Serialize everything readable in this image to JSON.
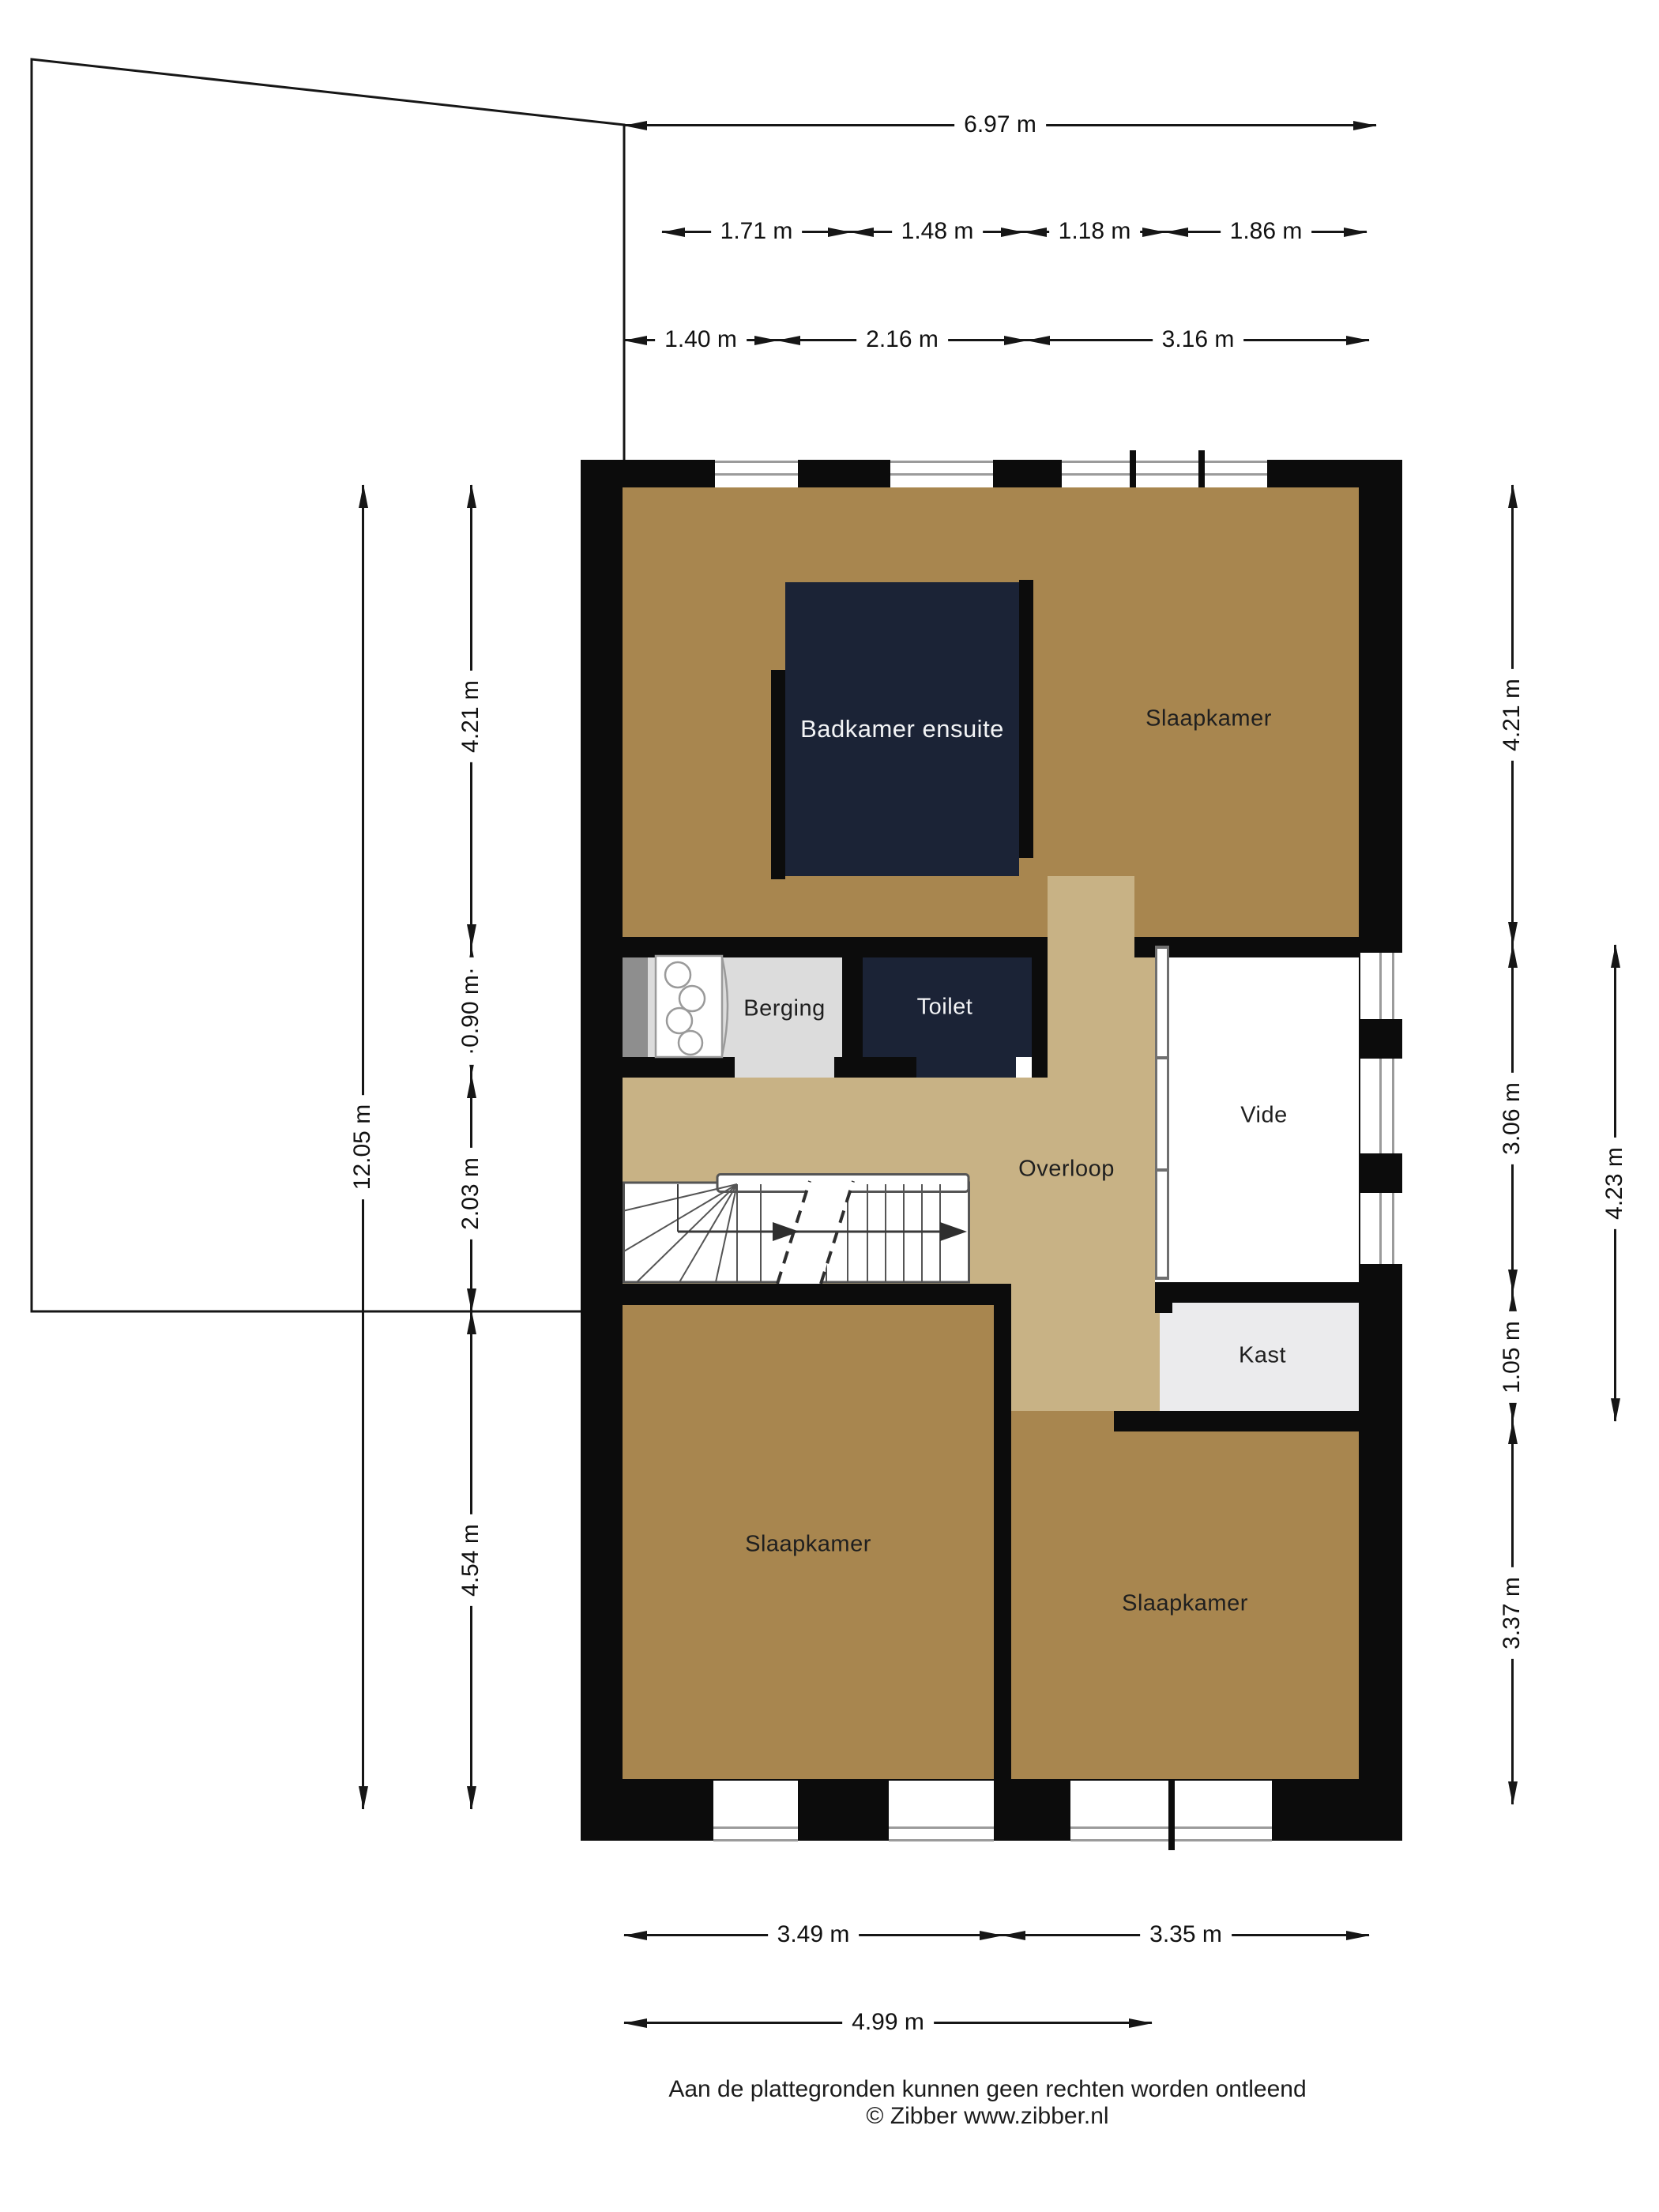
{
  "floorplan": {
    "rooms": {
      "badkamer_ensuite": "Badkamer ensuite",
      "slaapkamer_boven": "Slaapkamer",
      "berging": "Berging",
      "toilet": "Toilet",
      "vide": "Vide",
      "overloop": "Overloop",
      "kast": "Kast",
      "slaapkamer_linksonder": "Slaapkamer",
      "slaapkamer_rechtsonder": "Slaapkamer"
    },
    "dimensions": {
      "top_total": "6.97 m",
      "top_row2": [
        "1.71 m",
        "1.48 m",
        "1.18 m",
        "1.86 m"
      ],
      "top_row3": [
        "1.40 m",
        "2.16 m",
        "3.16 m"
      ],
      "left_total": "12.05 m",
      "left_column": [
        "4.21 m",
        "·0.90 m·",
        "2.03 m",
        "4.54 m"
      ],
      "right_column": [
        "4.21 m",
        "3.06 m",
        "1.05 m",
        "3.37 m"
      ],
      "right_outer": "4.23 m",
      "bottom_row": [
        "3.49 m",
        "3.35 m"
      ],
      "bottom_total": "4.99 m"
    },
    "colors": {
      "room_brown": "#a8864f",
      "hallway_tan": "#c8b285",
      "bathroom_navy": "#1b2336",
      "storage_gray": "#dcdcdc",
      "counter_gray": "#8e8e8e",
      "closet_gray": "#ebebed",
      "wall_black": "#0c0c0c",
      "vide_white": "#ffffff"
    },
    "footer": {
      "disclaimer": "Aan de plattegronden kunnen geen rechten worden ontleend",
      "copyright": "© Zibber www.zibber.nl"
    }
  }
}
